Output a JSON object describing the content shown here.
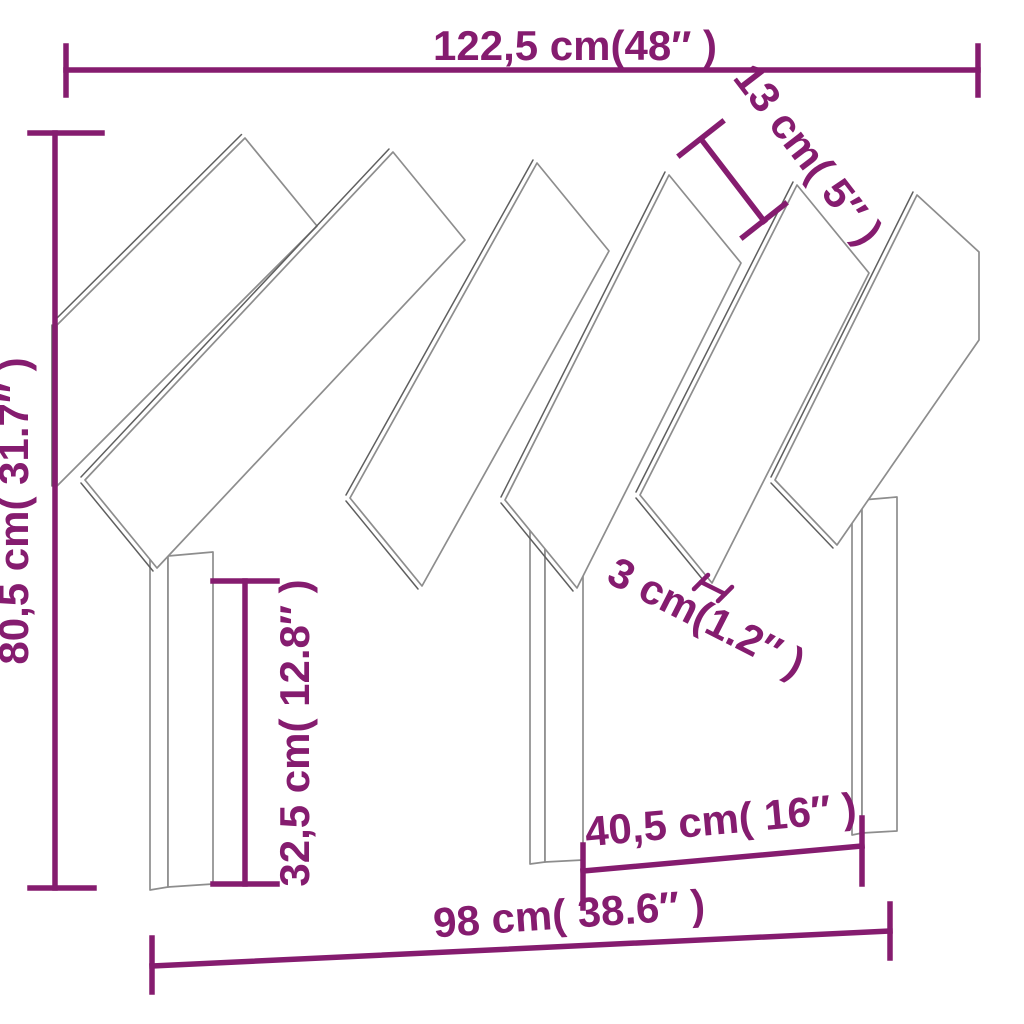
{
  "diagram": {
    "type": "product-dimension-diagram",
    "product": "headboard-with-angled-slats",
    "accent_color": "#851C6F",
    "outline_color": "#8d8d8d",
    "background_color": "#ffffff",
    "dimensions": {
      "overall_width": {
        "label": "122,5 cm(48″ )",
        "cm": 122.5,
        "inch": 48
      },
      "slat_width": {
        "label": "13 cm( 5″ )",
        "cm": 13,
        "inch": 5
      },
      "overall_height": {
        "label": "80,5 cm( 31.7″ )",
        "cm": 80.5,
        "inch": 31.7
      },
      "leg_height": {
        "label": "32,5 cm( 12.8″ )",
        "cm": 32.5,
        "inch": 12.8
      },
      "slat_gap": {
        "label": "3 cm(1.2″ )",
        "cm": 3,
        "inch": 1.2
      },
      "inner_leg_span": {
        "label": "40,5 cm( 16″ )",
        "cm": 40.5,
        "inch": 16
      },
      "base_width": {
        "label": "98 cm( 38.6″ )",
        "cm": 98,
        "inch": 38.6
      }
    }
  }
}
